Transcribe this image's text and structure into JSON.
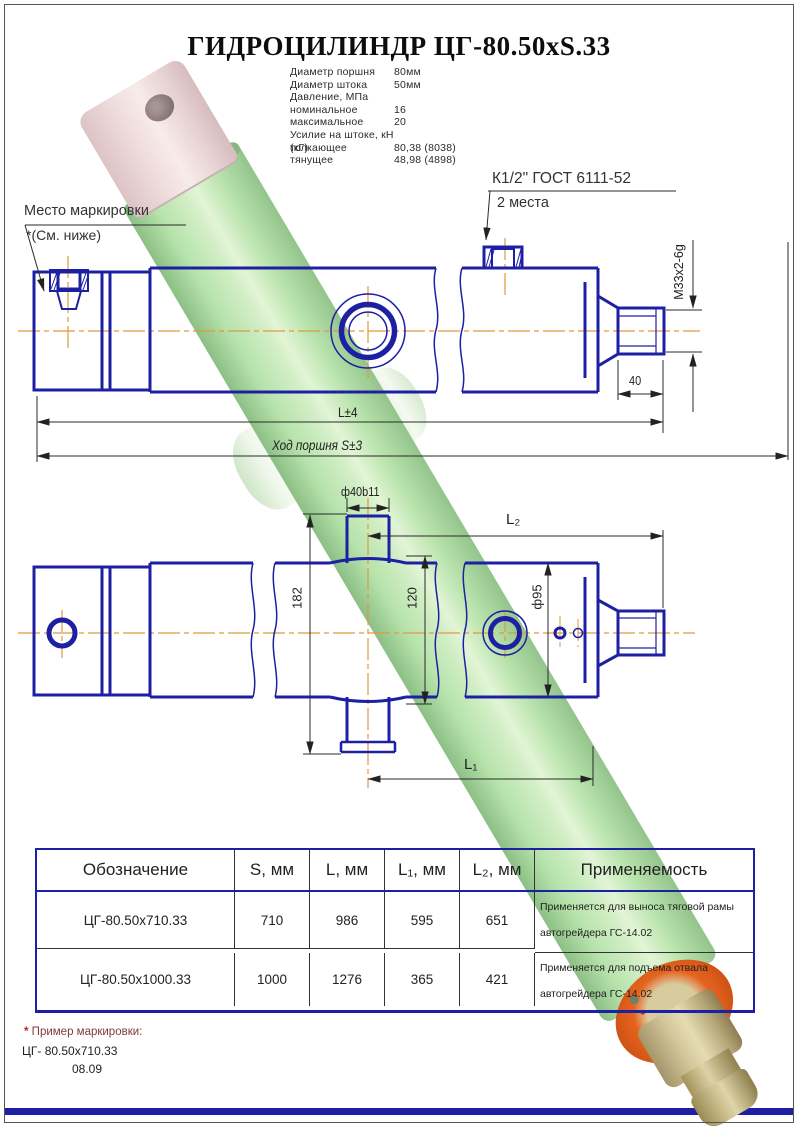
{
  "title": "ГИДРОЦИЛИНДР ЦГ-80.50xS.33",
  "specs": {
    "rows": [
      {
        "label": "Диаметр поршня",
        "value": "80мм"
      },
      {
        "label": "Диаметр штока",
        "value": "50мм"
      },
      {
        "label": "Давление, МПа",
        "value": ""
      },
      {
        "label": "номинальное",
        "value": "16"
      },
      {
        "label": "максимальное",
        "value": "20"
      },
      {
        "label": "Усилие на штоке, кН (кГ)",
        "value": ""
      },
      {
        "label": "толкающее",
        "value": "80,38 (8038)"
      },
      {
        "label": "тянущее",
        "value": "48,98 (4898)"
      }
    ]
  },
  "callouts": {
    "marking_place": "Место маркировки",
    "marking_note": "*(См. ниже)",
    "port_thread": "К1/2\" ГОСТ 6111-52",
    "port_places": "2 места"
  },
  "dimensions": {
    "rod_thread": "M33x2-6g",
    "length": "L±4",
    "stroke": "Ход поршня S±3",
    "stud_length": "40",
    "pin_dia": "ф40b11",
    "l2": "L₂",
    "pin_span": "182",
    "boss_span": "120",
    "barrel_dia": "ф95",
    "l1": "L₁"
  },
  "table": {
    "headers": [
      "Обозначение",
      "S, мм",
      "L, мм",
      "L₁, мм",
      "L₂, мм",
      "Применяемость"
    ],
    "rows": [
      {
        "designation": "ЦГ-80.50х710.33",
        "s": "710",
        "l": "986",
        "l1": "595",
        "l2": "651",
        "application": "Применяется для выноса тяговой рамы автогрейдера ГС-14.02"
      },
      {
        "designation": "ЦГ-80.50х1000.33",
        "s": "1000",
        "l": "1276",
        "l1": "365",
        "l2": "421",
        "application": "Применяется для  подъема отвала автогрейдера ГС-14.02"
      }
    ]
  },
  "footnote": {
    "star": "*",
    "line1": " Пример маркировки:",
    "line2": "ЦГ- 80.50х710.33",
    "line3": "08.09"
  }
}
